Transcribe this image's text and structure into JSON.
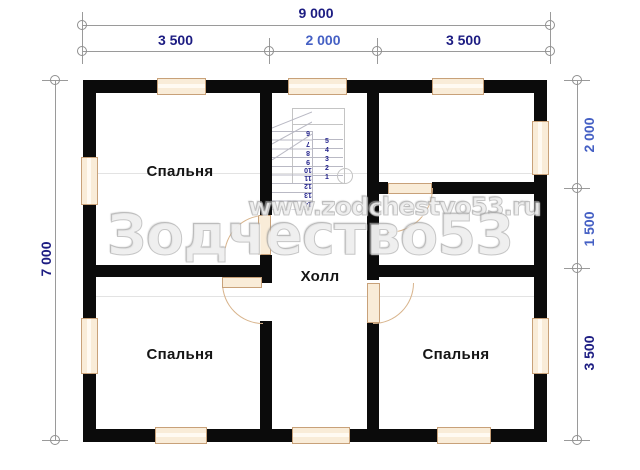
{
  "title": "floor-plan",
  "dimensions": {
    "top_total": "9 000",
    "top_left": "3 500",
    "top_mid": "2 000",
    "top_right": "3 500",
    "left_total": "7 000",
    "right_top": "2 000",
    "right_mid": "1 500",
    "right_bottom": "3 500"
  },
  "rooms": {
    "top_left": "Спальня",
    "bottom_left": "Спальня",
    "bottom_right": "Спальня",
    "hall": "Холл"
  },
  "stairs": {
    "flight_a": [
      "5",
      "4",
      "3",
      "2",
      "1"
    ],
    "flight_b": [
      "6",
      "7",
      "8",
      "9",
      "10",
      "11",
      "12",
      "13",
      "14"
    ]
  },
  "watermark": {
    "site": "www.zodchestvo53.ru",
    "brand": "Зодчество53"
  },
  "colors": {
    "wall": "#0b0b0b",
    "window_fill": "#f9ecd8",
    "window_border": "#c8a179",
    "dim_navy": "#1c1c82",
    "dim_blue": "#4560c4",
    "grid_line": "#9a9a9a",
    "watermark_gray": "#cdcdcd"
  }
}
